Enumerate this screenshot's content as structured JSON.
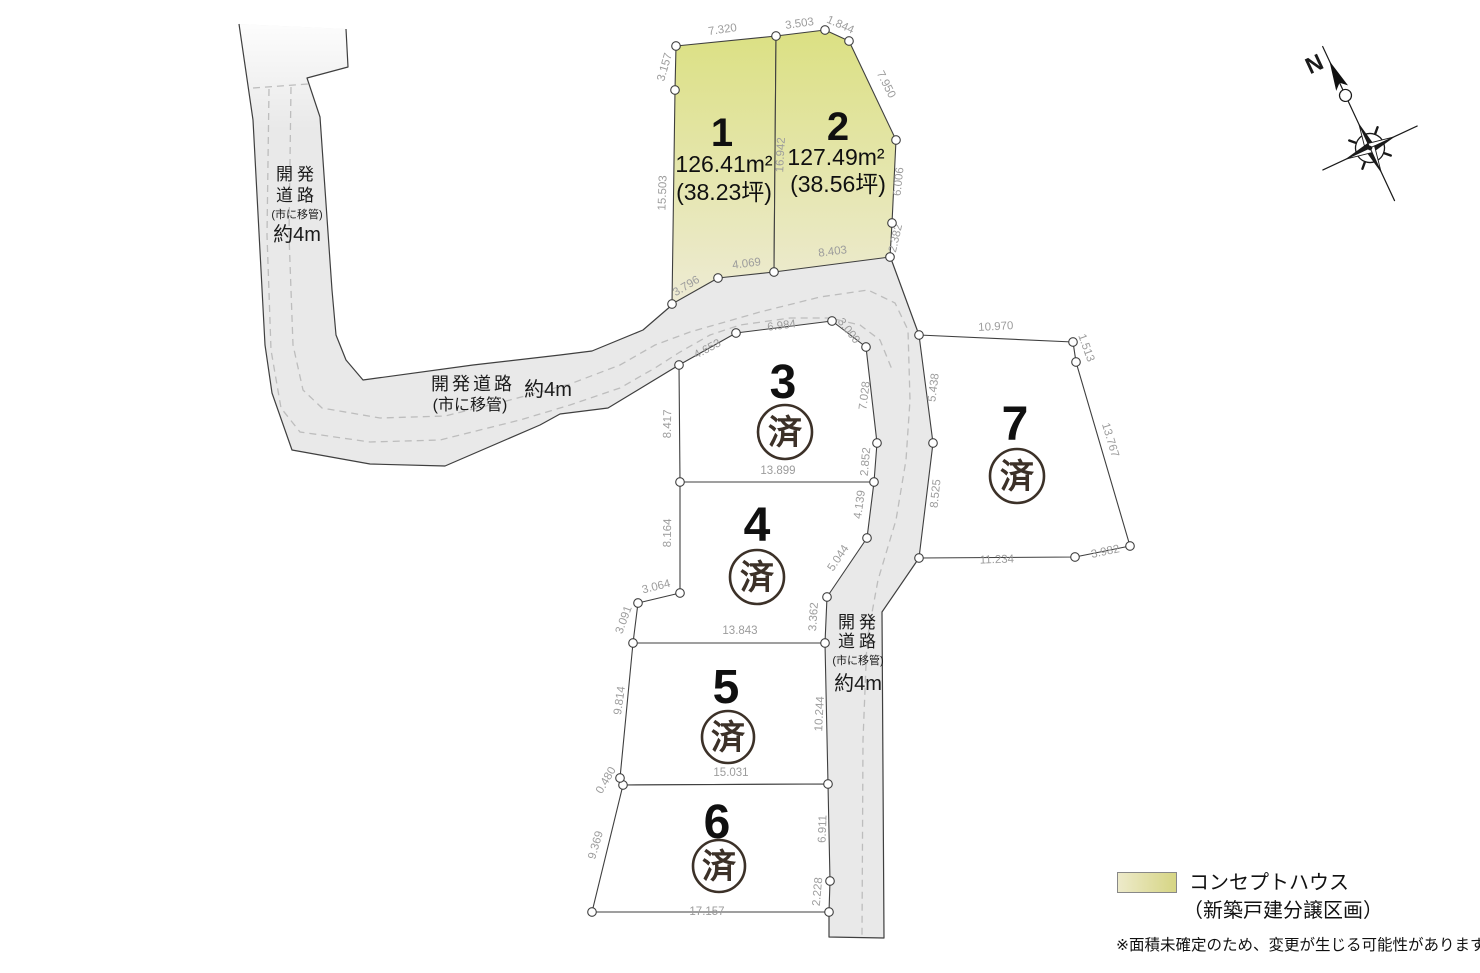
{
  "map": {
    "lots": [
      {
        "number": "1",
        "nx": 722,
        "ny": 146,
        "nsize": 40,
        "area": "126.41m²",
        "ax": 724,
        "ay": 172,
        "tsubo": "(38.23坪)",
        "tx": 724,
        "ty": 200,
        "status": ""
      },
      {
        "number": "2",
        "nx": 838,
        "ny": 140,
        "nsize": 40,
        "area": "127.49m²",
        "ax": 836,
        "ay": 165,
        "tsubo": "(38.56坪)",
        "tx": 838,
        "ty": 192,
        "status": ""
      },
      {
        "number": "3",
        "nx": 783,
        "ny": 398,
        "nsize": 48,
        "status": "済",
        "sx": 785,
        "sy": 432,
        "sr": 27
      },
      {
        "number": "4",
        "nx": 757,
        "ny": 541,
        "nsize": 48,
        "status": "済",
        "sx": 757,
        "sy": 577,
        "sr": 27
      },
      {
        "number": "5",
        "nx": 726,
        "ny": 703,
        "nsize": 48,
        "status": "済",
        "sx": 728,
        "sy": 737,
        "sr": 26
      },
      {
        "number": "6",
        "nx": 717,
        "ny": 838,
        "nsize": 48,
        "status": "済",
        "sx": 719,
        "sy": 866,
        "sr": 26
      },
      {
        "number": "7",
        "nx": 1015,
        "ny": 440,
        "nsize": 48,
        "status": "済",
        "sx": 1017,
        "sy": 476,
        "sr": 27
      }
    ],
    "dimensions": [
      {
        "t": "7.320",
        "x": 723,
        "y": 33,
        "r": -8
      },
      {
        "t": "3.503",
        "x": 800,
        "y": 27,
        "r": -8
      },
      {
        "t": "1.844",
        "x": 839,
        "y": 28,
        "r": 24
      },
      {
        "t": "3.157",
        "x": 668,
        "y": 68,
        "r": -74
      },
      {
        "t": "15.503",
        "x": 666,
        "y": 193,
        "r": -88
      },
      {
        "t": "16.942",
        "x": 784,
        "y": 155,
        "r": -87
      },
      {
        "t": "7.950",
        "x": 883,
        "y": 86,
        "r": 63
      },
      {
        "t": "6.006",
        "x": 902,
        "y": 182,
        "r": -84
      },
      {
        "t": "2.382",
        "x": 899,
        "y": 239,
        "r": -77
      },
      {
        "t": "8.403",
        "x": 833,
        "y": 255,
        "r": -7
      },
      {
        "t": "4.069",
        "x": 747,
        "y": 267,
        "r": -7
      },
      {
        "t": "3.796",
        "x": 688,
        "y": 289,
        "r": -31
      },
      {
        "t": "4.653",
        "x": 709,
        "y": 352,
        "r": -28
      },
      {
        "t": "6.984",
        "x": 782,
        "y": 329,
        "r": -7
      },
      {
        "t": "3.000",
        "x": 846,
        "y": 333,
        "r": 52
      },
      {
        "t": "7.028",
        "x": 868,
        "y": 396,
        "r": -83
      },
      {
        "t": "8.417",
        "x": 671,
        "y": 424,
        "r": -89
      },
      {
        "t": "2.852",
        "x": 869,
        "y": 462,
        "r": -85
      },
      {
        "t": "13.899",
        "x": 778,
        "y": 474,
        "r": 0
      },
      {
        "t": "5.438",
        "x": 937,
        "y": 388,
        "r": -83
      },
      {
        "t": "8.525",
        "x": 939,
        "y": 494,
        "r": -84
      },
      {
        "t": "4.139",
        "x": 863,
        "y": 505,
        "r": -82
      },
      {
        "t": "8.164",
        "x": 671,
        "y": 533,
        "r": -89
      },
      {
        "t": "5.044",
        "x": 841,
        "y": 560,
        "r": -56
      },
      {
        "t": "3.064",
        "x": 657,
        "y": 590,
        "r": -14
      },
      {
        "t": "3.362",
        "x": 817,
        "y": 617,
        "r": -86
      },
      {
        "t": "3.091",
        "x": 627,
        "y": 621,
        "r": -70
      },
      {
        "t": "13.843",
        "x": 740,
        "y": 634,
        "r": 0
      },
      {
        "t": "9.814",
        "x": 623,
        "y": 701,
        "r": -82
      },
      {
        "t": "10.244",
        "x": 823,
        "y": 714,
        "r": -87
      },
      {
        "t": "15.031",
        "x": 731,
        "y": 776,
        "r": 0
      },
      {
        "t": "0.480",
        "x": 609,
        "y": 782,
        "r": -60
      },
      {
        "t": "9.369",
        "x": 599,
        "y": 846,
        "r": -74
      },
      {
        "t": "6.911",
        "x": 826,
        "y": 829,
        "r": -88
      },
      {
        "t": "2.228",
        "x": 821,
        "y": 892,
        "r": -85
      },
      {
        "t": "17.157",
        "x": 707,
        "y": 915,
        "r": 0
      },
      {
        "t": "10.970",
        "x": 996,
        "y": 330,
        "r": -3
      },
      {
        "t": "1.513",
        "x": 1083,
        "y": 349,
        "r": 70
      },
      {
        "t": "13.767",
        "x": 1107,
        "y": 441,
        "r": 73
      },
      {
        "t": "3.982",
        "x": 1106,
        "y": 555,
        "r": -12
      },
      {
        "t": "11.234",
        "x": 997,
        "y": 563,
        "r": -2
      }
    ],
    "road_labels": [
      {
        "t": "開発",
        "x": 297,
        "y": 180,
        "s": 17,
        "ls": 4
      },
      {
        "t": "道路",
        "x": 297,
        "y": 201,
        "s": 17,
        "ls": 4
      },
      {
        "t": "(市に移管)",
        "x": 297,
        "y": 218,
        "s": 11,
        "ls": 0
      },
      {
        "t": "約4m",
        "x": 297,
        "y": 241,
        "s": 20,
        "ls": 0
      },
      {
        "t": "開発道路",
        "x": 473,
        "y": 390,
        "s": 18,
        "ls": 3
      },
      {
        "t": "(市に移管)",
        "x": 470,
        "y": 410,
        "s": 16,
        "ls": 0
      },
      {
        "t": "約4m",
        "x": 548,
        "y": 396,
        "s": 20,
        "ls": 0
      },
      {
        "t": "開発",
        "x": 859,
        "y": 628,
        "s": 17,
        "ls": 4
      },
      {
        "t": "道路",
        "x": 859,
        "y": 647,
        "s": 17,
        "ls": 4
      },
      {
        "t": "(市に移管)",
        "x": 858,
        "y": 664,
        "s": 11,
        "ls": 0
      },
      {
        "t": "約4m",
        "x": 858,
        "y": 690,
        "s": 20,
        "ls": 0
      }
    ],
    "compass": {
      "label": "N"
    },
    "colors": {
      "concept_top": "#dbe081",
      "concept_bottom": "#eeebd6",
      "road_fill": "#e9e9e9",
      "line": "#3f3f3f",
      "dimension_text": "#9c9c9c",
      "sold_stamp": "#3c3128"
    }
  },
  "legend": {
    "line1": "コンセプトハウス",
    "line2": "（新築戸建分譲区画）",
    "note": "※面積未確定のため、変更が生じる可能性があります。"
  }
}
